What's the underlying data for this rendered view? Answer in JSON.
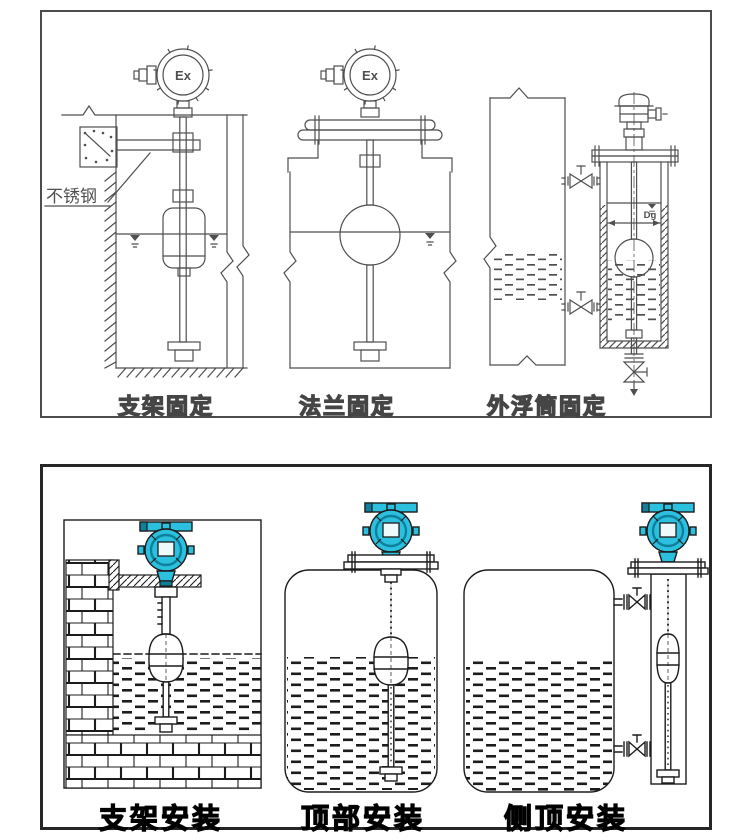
{
  "colors": {
    "line_top": "#4f4f4f",
    "line_bottom": "#1c1c1c",
    "teal": "#2cc0df",
    "teal_dark": "#0f7f9c",
    "teal_display": "#eef9fc"
  },
  "top_panel": {
    "diagrams": [
      {
        "caption": "支架固定",
        "ex_label": "Ex",
        "note_label": "不锈钢"
      },
      {
        "caption": "法兰固定",
        "ex_label": "Ex"
      },
      {
        "caption": "外浮筒固定",
        "dim_label": "Dg"
      }
    ]
  },
  "bottom_panel": {
    "diagrams": [
      {
        "caption": "支架安装"
      },
      {
        "caption": "顶部安装"
      },
      {
        "caption": "侧顶安装"
      }
    ]
  }
}
